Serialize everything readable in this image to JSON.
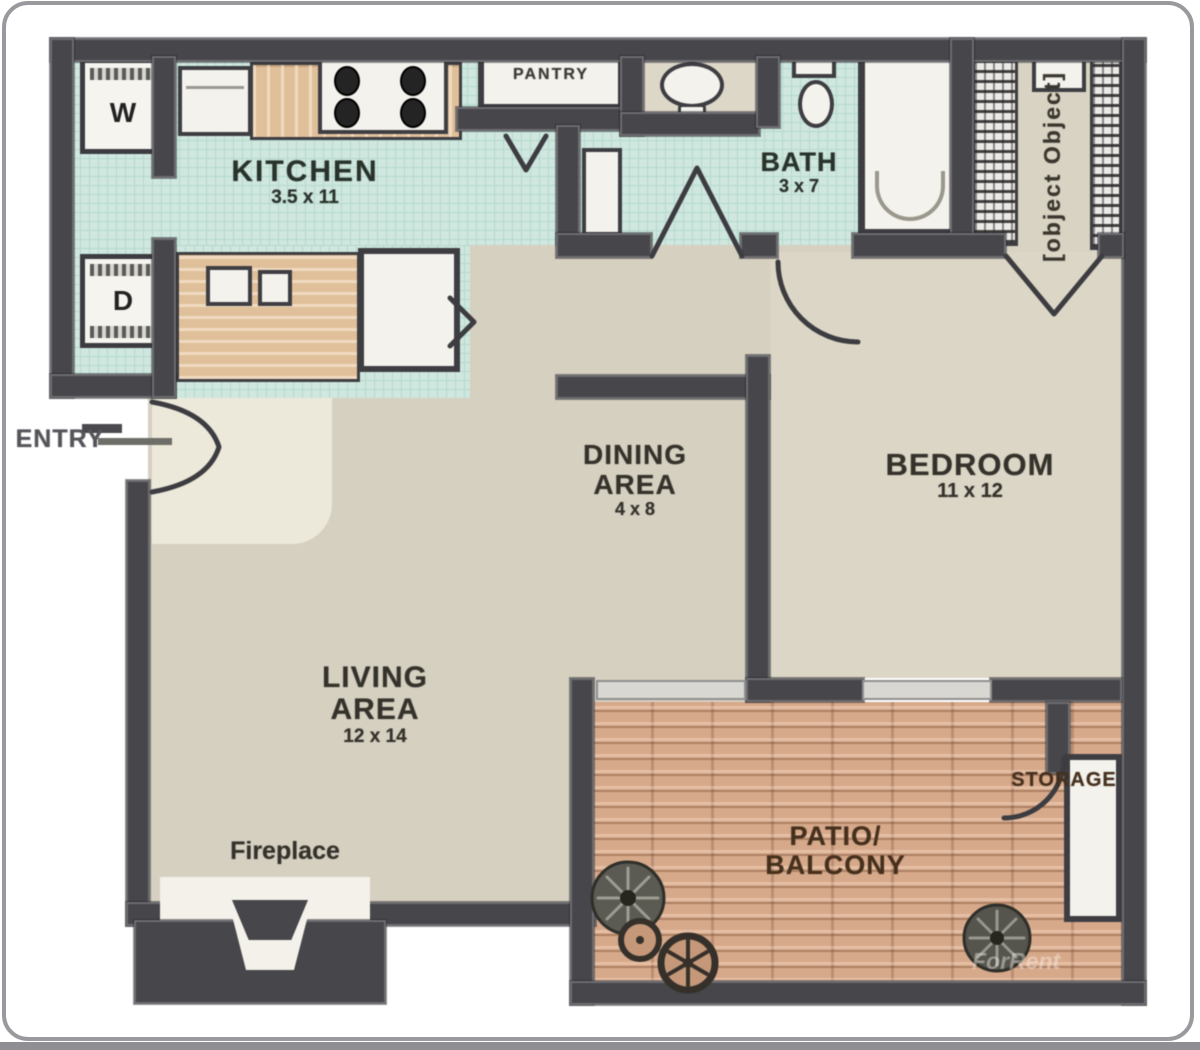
{
  "plan": {
    "labels": {
      "kitchen": {
        "name": "KITCHEN",
        "dims": "3.5 x 11"
      },
      "pantry": {
        "name": "PANTRY"
      },
      "bath": {
        "name": "BATH",
        "dims": "3 x 7"
      },
      "closet": {
        "name": "CLOSET"
      },
      "bedroom": {
        "name": "BEDROOM",
        "dims": "11 x 12"
      },
      "dining": {
        "line1": "DINING",
        "line2": "AREA",
        "dims": "4 x 8"
      },
      "living": {
        "line1": "LIVING",
        "line2": "AREA",
        "dims": "12 x 14"
      },
      "fireplace": {
        "name": "Fireplace"
      },
      "patio": {
        "line1": "PATIO/",
        "line2": "BALCONY"
      },
      "storage": {
        "name": "STORAGE"
      },
      "entry": {
        "name": "ENTRY"
      }
    },
    "appliances": {
      "washer": "W",
      "dryer": "D"
    },
    "watermark": "ForRent",
    "colors": {
      "wall": "#47474b",
      "tile": "#cfe7df",
      "tile_line": "#b4d9cd",
      "floor": "#d6d0c1",
      "floor_bedroom": "#dcd6c6",
      "floor_entry": "#ece8da",
      "floor_closet": "#d9d3c3",
      "counter": "#dfc09b",
      "patio": "#d7a98b",
      "fixture": "#f4f2ec",
      "label": "#34322b",
      "label_teal": "#28332c",
      "label_brown": "#46301c"
    }
  }
}
